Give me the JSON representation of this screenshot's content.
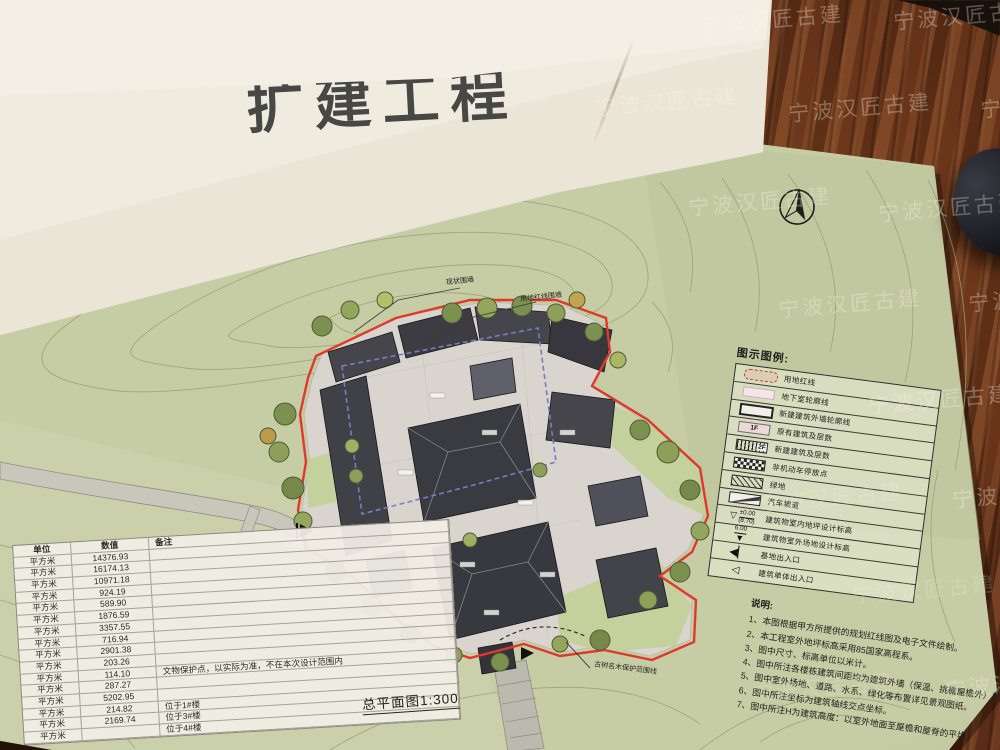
{
  "photo": {
    "watermark": "宁波汉匠古建"
  },
  "cover": {
    "title_fragment": "扩建工程"
  },
  "plan": {
    "drawing_title": "总平面图1:300",
    "north_label": "N",
    "callouts": {
      "wall_top": "现状围墙",
      "wall_right": "用地红线围墙",
      "ancient_tree_line": "古树名木保护范围线"
    },
    "legend": {
      "title": "图示图例:",
      "floor_existing": "1F",
      "floor_new": "2F",
      "indoor_elev_main": "±0.00",
      "indoor_elev_sub": "(8.70)",
      "outdoor_elev": "6.00",
      "items": [
        {
          "label": "用地红线"
        },
        {
          "label": "地下室轮廓线"
        },
        {
          "label": "新建建筑外墙轮廓线"
        },
        {
          "label": "原有建筑及层数"
        },
        {
          "label": "新建建筑及层数"
        },
        {
          "label": "非机动车停放点"
        },
        {
          "label": "绿地"
        },
        {
          "label": "汽车坡道"
        },
        {
          "label": "建筑物室内地坪设计标高"
        },
        {
          "label": "建筑物室外场地设计标高"
        },
        {
          "label": "基地出入口"
        },
        {
          "label": "建筑单体出入口"
        }
      ]
    },
    "notes": {
      "title": "说明:",
      "items": [
        "1、本图根据甲方所提供的规划红线图及电子文件绘制。",
        "2、本工程室外地坪标高采用85国家高程系。",
        "3、图中尺寸、标高单位以米计。",
        "4、图中所注各楼栋建筑间距均为建筑外墙（保温、挑檐屋檐外）尺寸。",
        "5、图中室外场地、道路、水系、绿化等布置详见景观图纸。",
        "6、图中所注坐标为建筑轴线交点坐标。",
        "7、图中所注H为建筑高度：以室外地面至屋檐和屋脊的平均"
      ]
    },
    "table": {
      "headers": [
        "单位",
        "数值",
        "备注"
      ],
      "rows": [
        {
          "unit": "平方米",
          "value": "14376.93",
          "remark": ""
        },
        {
          "unit": "平方米",
          "value": "16174.13",
          "remark": ""
        },
        {
          "unit": "平方米",
          "value": "10971.18",
          "remark": ""
        },
        {
          "unit": "平方米",
          "value": "924.19",
          "remark": ""
        },
        {
          "unit": "平方米",
          "value": "589.90",
          "remark": ""
        },
        {
          "unit": "平方米",
          "value": "1876.59",
          "remark": ""
        },
        {
          "unit": "平方米",
          "value": "3357.55",
          "remark": ""
        },
        {
          "unit": "平方米",
          "value": "716.94",
          "remark": ""
        },
        {
          "unit": "平方米",
          "value": "2901.38",
          "remark": ""
        },
        {
          "unit": "平方米",
          "value": "203.26",
          "remark": ""
        },
        {
          "unit": "平方米",
          "value": "114.10",
          "remark": "文物保护点，以实际为准，不在本次设计范围内"
        },
        {
          "unit": "平方米",
          "value": "287.27",
          "remark": ""
        },
        {
          "unit": "平方米",
          "value": "5202.95",
          "remark": ""
        },
        {
          "unit": "平方米",
          "value": "214.82",
          "remark": "位于1#楼"
        },
        {
          "unit": "平方米",
          "value": "2169.74",
          "remark": "位于3#楼"
        },
        {
          "unit": "平方米",
          "value": "",
          "remark": "位于4#楼"
        }
      ]
    }
  }
}
